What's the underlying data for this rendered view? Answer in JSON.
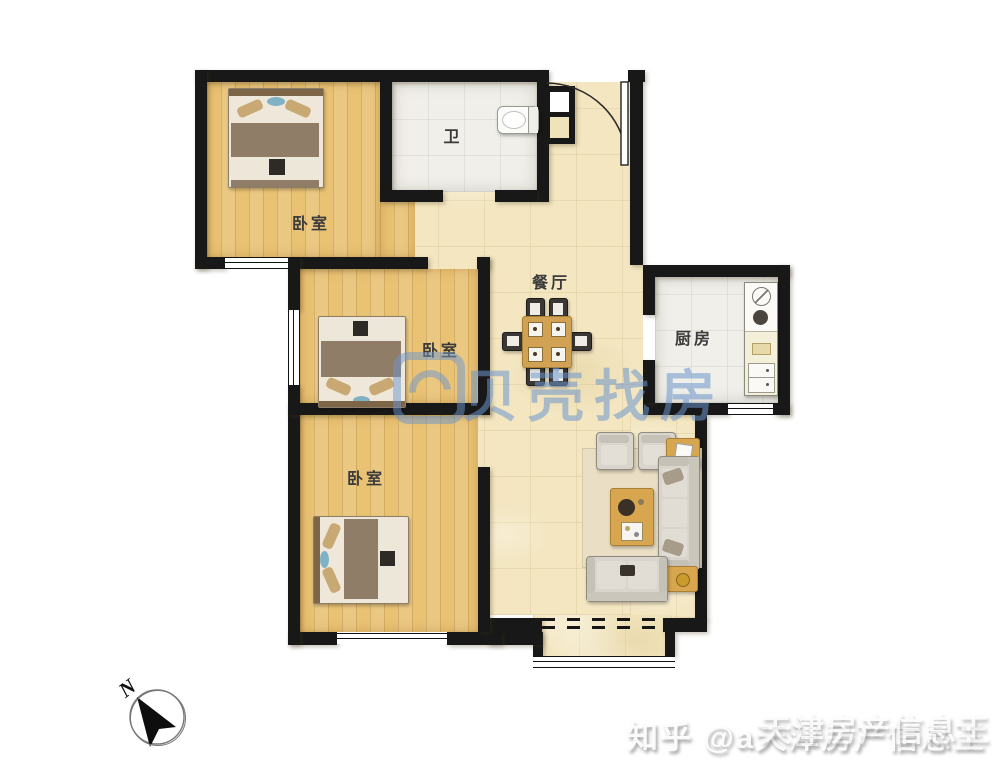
{
  "rooms": {
    "bedroom_top": "卧室",
    "bathroom": "卫",
    "dining": "餐厅",
    "kitchen": "厨房",
    "bedroom_middle": "卧室",
    "bedroom_bottom": "卧室"
  },
  "compass": {
    "label": "N"
  },
  "watermarks": {
    "center_text": "贝壳找房",
    "corner_text": "知乎 @a天津房产信息王",
    "corner_overlap_text": "天津房产信息王"
  },
  "colors": {
    "wall": "#181818",
    "wood_floor": "#E9C274",
    "hall_tile": "#F3E6C1",
    "wet_room_tile": "#F0EFEA",
    "watermark_blue": "#6C96CE",
    "bed_blanket": "#8F7D68",
    "sofa_gray": "#D9D5CC",
    "table_wood": "#D7A64E"
  }
}
